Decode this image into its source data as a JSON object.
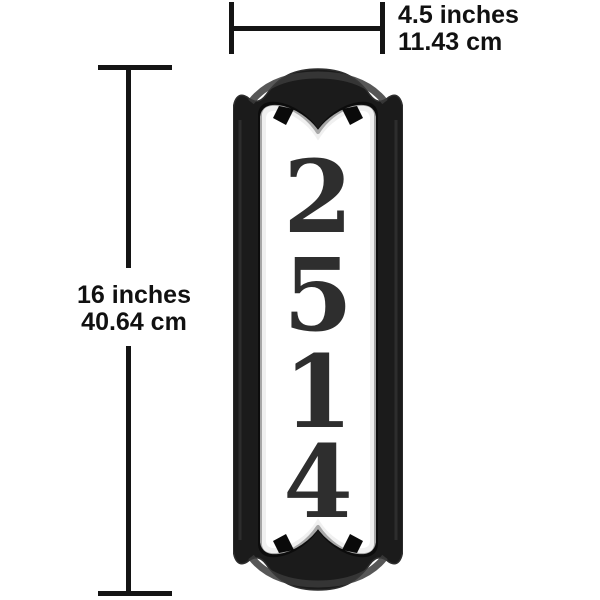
{
  "page": {
    "background": "#ffffff"
  },
  "dimensions": {
    "width": {
      "imperial": "4.5 inches",
      "metric": "11.43 cm"
    },
    "height": {
      "imperial": "16 inches",
      "metric": "40.64 cm"
    }
  },
  "plaque": {
    "digits": [
      "2",
      "5",
      "1",
      "4"
    ],
    "frame_color": "#1b1b1b",
    "frame_edge_color": "#2e2e2e",
    "sheen_color": "#3a3a3a",
    "notch_color": "#0a0a0a",
    "panel_color": "#ffffff",
    "panel_shade_color": "#e9e9e9",
    "inner_edge_color": "#0c0c0c",
    "digit_color": "#2e2e2e"
  },
  "annotation": {
    "line_color": "#141414",
    "text_color": "#111111"
  }
}
